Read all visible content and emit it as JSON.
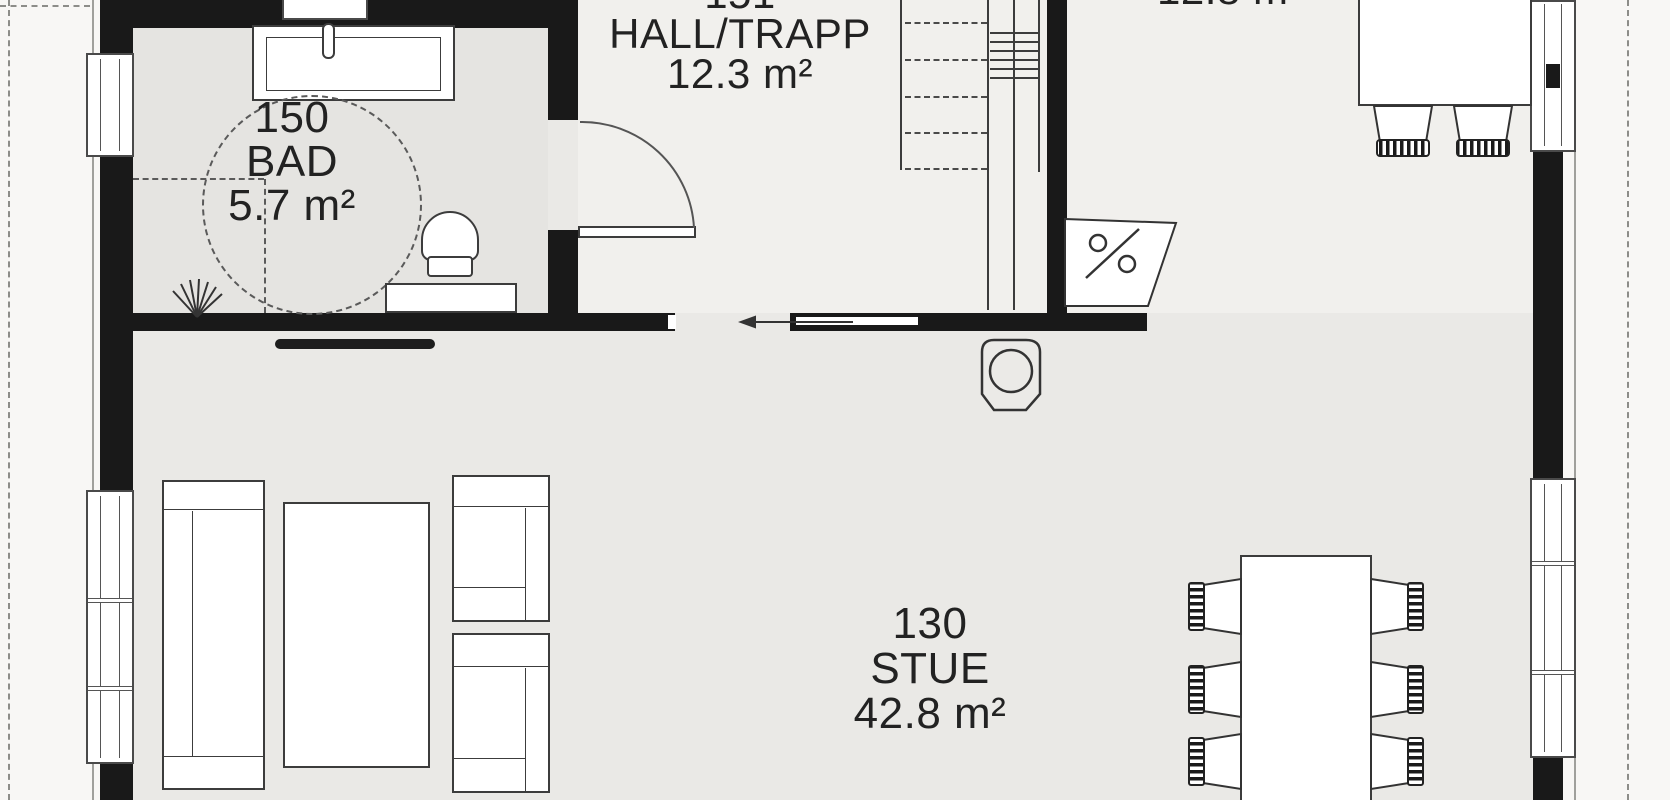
{
  "plan": {
    "type": "architectural floor plan",
    "rooms": {
      "bad": {
        "number": "150",
        "name": "BAD",
        "area": "5.7 m²"
      },
      "hall": {
        "number": "151",
        "name": "HALL/TRAPP",
        "area": "12.3 m²",
        "number_clipped_at_top": true
      },
      "stue": {
        "number": "130",
        "name": "STUE",
        "area": "42.8 m²"
      },
      "kitchen": {
        "area": "12.8 m²",
        "label_clipped_at_top": true
      }
    },
    "symbols": [
      "wheelchair-turning-circle",
      "floor-drain",
      "toilet",
      "vanity-sink",
      "faucet",
      "bathroom-bench",
      "hinged-door-swing",
      "sliding-door-arrow",
      "staircase",
      "wood-stove",
      "dishwasher",
      "kitchen-island",
      "bar-stool",
      "tv-bench",
      "sofa",
      "coffee-table",
      "armchair",
      "dining-table",
      "dining-chair",
      "window",
      "wall",
      "roof-overhang-dashed-line"
    ],
    "colors": {
      "wall": "#191919",
      "line": "#3c3c3c",
      "floor_living": "#eae9e6",
      "floor_hall": "#f1f0ed",
      "floor_bath": "#e5e4e1",
      "outside": "#f8f7f5",
      "text": "#222222"
    }
  }
}
